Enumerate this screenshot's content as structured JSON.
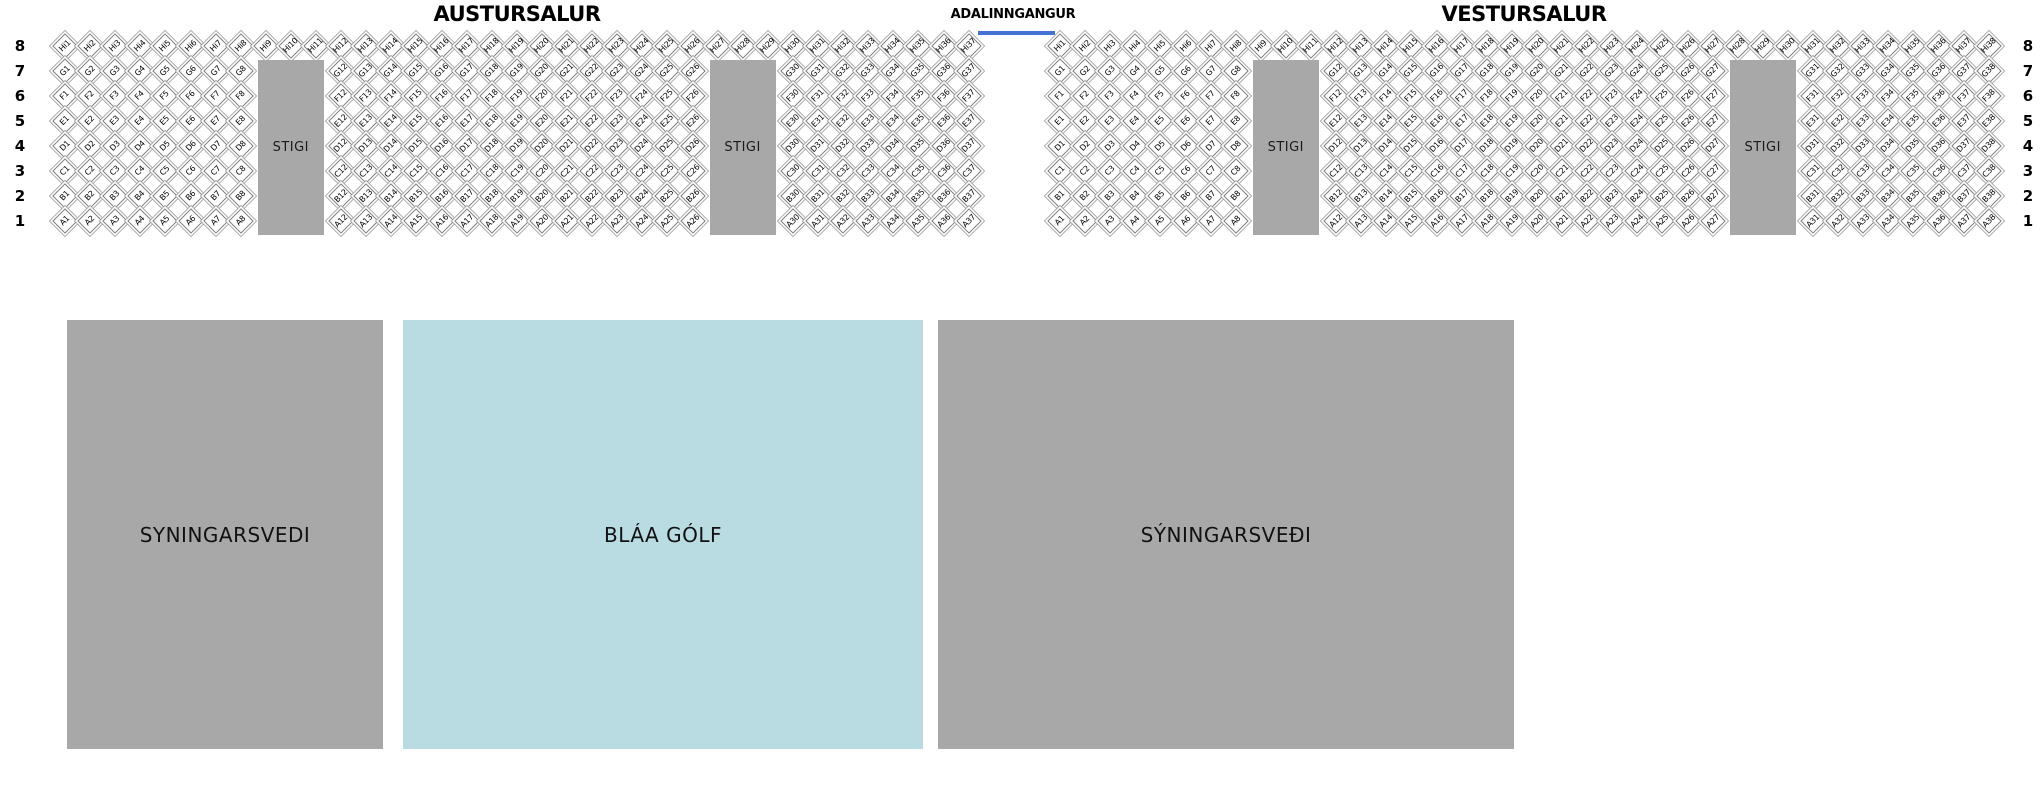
{
  "halls": [
    {
      "id": "austursalur",
      "title": "AUSTURSALUR",
      "rows": [
        {
          "number": 8,
          "letter": "Hi",
          "segments": [
            [
              1,
              37
            ]
          ]
        },
        {
          "number": 7,
          "letter": "G",
          "segments": [
            [
              1,
              8
            ],
            [
              12,
              26
            ],
            [
              30,
              37
            ]
          ]
        },
        {
          "number": 6,
          "letter": "F",
          "segments": [
            [
              1,
              8
            ],
            [
              12,
              26
            ],
            [
              30,
              37
            ]
          ]
        },
        {
          "number": 5,
          "letter": "E",
          "segments": [
            [
              1,
              8
            ],
            [
              12,
              26
            ],
            [
              30,
              37
            ]
          ]
        },
        {
          "number": 4,
          "letter": "D",
          "segments": [
            [
              1,
              8
            ],
            [
              12,
              26
            ],
            [
              30,
              37
            ]
          ]
        },
        {
          "number": 3,
          "letter": "C",
          "segments": [
            [
              1,
              8
            ],
            [
              12,
              26
            ],
            [
              30,
              37
            ]
          ]
        },
        {
          "number": 2,
          "letter": "B",
          "segments": [
            [
              1,
              8
            ],
            [
              12,
              26
            ],
            [
              30,
              37
            ]
          ]
        },
        {
          "number": 1,
          "letter": "A",
          "segments": [
            [
              1,
              8
            ],
            [
              12,
              26
            ],
            [
              30,
              37
            ]
          ]
        }
      ],
      "stairs": [
        {
          "label": "STIGI",
          "start_col": 9,
          "end_col": 11
        },
        {
          "label": "STIGI",
          "start_col": 27,
          "end_col": 29
        }
      ]
    },
    {
      "id": "vestursalur",
      "title": "VESTURSALUR",
      "rows": [
        {
          "number": 8,
          "letter": "Hi",
          "segments": [
            [
              1,
              38
            ]
          ]
        },
        {
          "number": 7,
          "letter": "G",
          "segments": [
            [
              1,
              8
            ],
            [
              12,
              27
            ],
            [
              31,
              38
            ]
          ]
        },
        {
          "number": 6,
          "letter": "F",
          "segments": [
            [
              1,
              8
            ],
            [
              12,
              27
            ],
            [
              31,
              38
            ]
          ]
        },
        {
          "number": 5,
          "letter": "E",
          "segments": [
            [
              1,
              8
            ],
            [
              12,
              27
            ],
            [
              31,
              38
            ]
          ]
        },
        {
          "number": 4,
          "letter": "D",
          "segments": [
            [
              1,
              8
            ],
            [
              12,
              27
            ],
            [
              31,
              38
            ]
          ]
        },
        {
          "number": 3,
          "letter": "C",
          "segments": [
            [
              1,
              8
            ],
            [
              12,
              27
            ],
            [
              31,
              38
            ]
          ]
        },
        {
          "number": 2,
          "letter": "B",
          "segments": [
            [
              1,
              8
            ],
            [
              12,
              27
            ],
            [
              31,
              38
            ]
          ]
        },
        {
          "number": 1,
          "letter": "A",
          "segments": [
            [
              1,
              8
            ],
            [
              12,
              27
            ],
            [
              31,
              38
            ]
          ]
        }
      ],
      "stairs": [
        {
          "label": "STIGI",
          "start_col": 9,
          "end_col": 11
        },
        {
          "label": "STIGI",
          "start_col": 28,
          "end_col": 30
        }
      ]
    }
  ],
  "entrance": {
    "label": "ADALINNGANGUR",
    "line_color": "#4472d4"
  },
  "floor_areas": [
    {
      "id": "syningarsvedi-left",
      "label": "SYNINGARSVEDI",
      "color": "#a8a8a8",
      "text_color": "#111111"
    },
    {
      "id": "blaa-golf",
      "label": "BLÁA GÓLF",
      "color": "#b8dce2",
      "text_color": "#111111"
    },
    {
      "id": "syningarsvedi-right",
      "label": "SÝNINGARSVEÐI",
      "color": "#a8a8a8",
      "text_color": "#111111"
    }
  ],
  "colors": {
    "stairs": "#a8a8a8",
    "seat_fill": "#ffffff",
    "seat_border": "#9a9a9a"
  }
}
